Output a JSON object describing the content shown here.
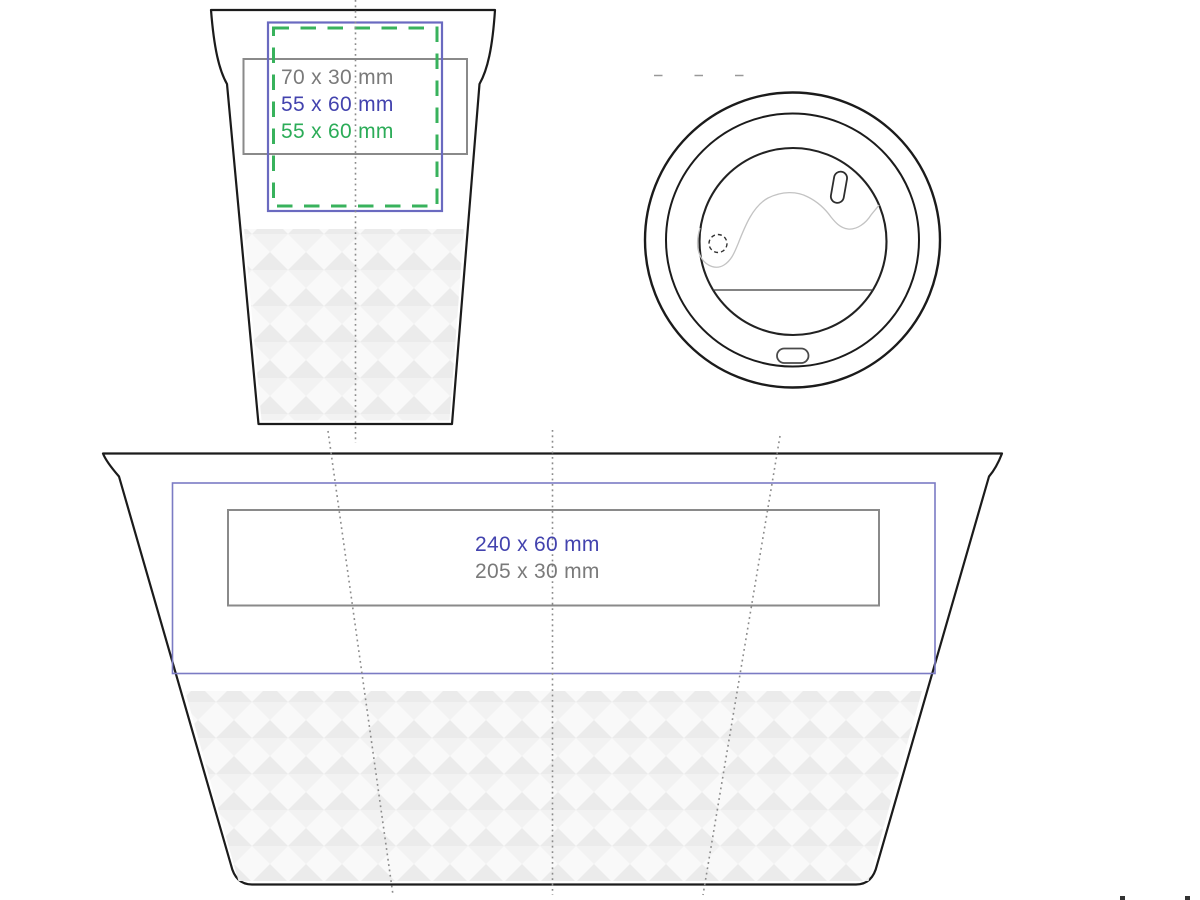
{
  "front_view": {
    "name": "cup front view print areas",
    "labels": [
      {
        "text": "70 x 30 mm",
        "color": "#7a7a7a",
        "area": "gray solid rectangle"
      },
      {
        "text": "55 x 60 mm",
        "color": "#4343ae",
        "area": "blue solid rectangle"
      },
      {
        "text": "55 x 60 mm",
        "color": "#2cac58",
        "area": "green dashed rectangle"
      }
    ]
  },
  "lid_view": {
    "name": "cup lid top view"
  },
  "unwrap_view": {
    "name": "cup unwrapped surface print areas",
    "labels": [
      {
        "text": "240 x 60 mm",
        "color": "#4343ae",
        "area": "blue solid rectangle"
      },
      {
        "text": "205 x 30 mm",
        "color": "#7a7a7a",
        "area": "gray solid rectangle"
      }
    ]
  },
  "colors": {
    "outline_black": "#1b1b1b",
    "print_area_blue_border": "#6a6ac0",
    "print_area_blue_border_light": "#7b7bc4",
    "print_area_green_border": "#38b25c",
    "print_area_gray_border": "#8a8a8a",
    "guide_dotted_gray": "#8b8b8b",
    "mechanism_gray": "#c3c3c3",
    "pattern_diamond_dark": "#ebebeb",
    "pattern_diamond_light": "#f2f2f2",
    "pattern_background": "#f9f9f9"
  }
}
